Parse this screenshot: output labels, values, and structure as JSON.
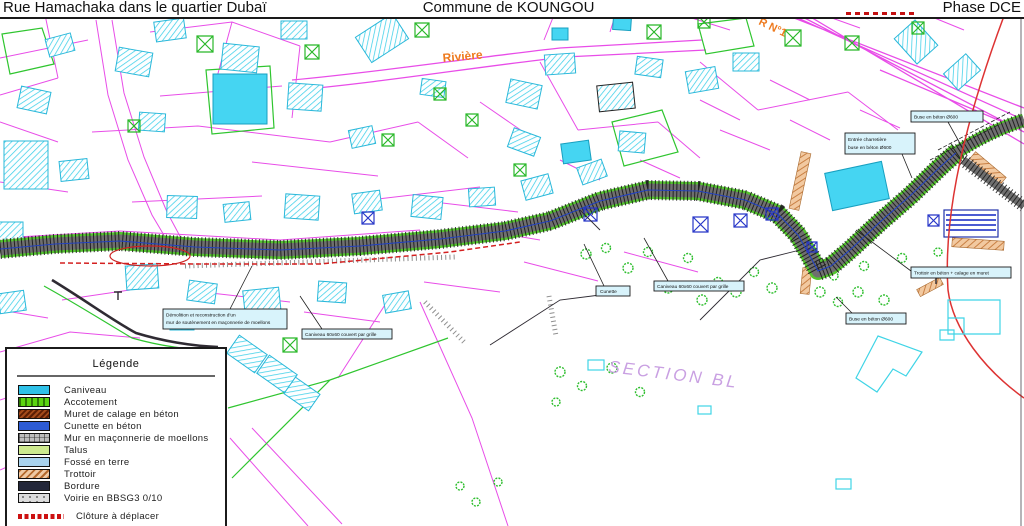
{
  "header": {
    "left_title": "Rue Hamachaka dans le quartier Dubaï",
    "center_title": "Commune de KOUNGOU",
    "right_title": "Phase DCE"
  },
  "map_labels": {
    "river": "Rivière",
    "rn1": "R N°1",
    "section": "SECTION BL"
  },
  "annotations": [
    {
      "line1": "Démolition et reconstruction d'un",
      "line2": "mur de soutènement en maçonnerie de moellons"
    },
    {
      "line1": "Caniveau 60x60 couvert par grille"
    },
    {
      "line1": "Cunette"
    },
    {
      "line1": "Caniveau 60x60 couvert par grille"
    },
    {
      "line1": "Entrée charretière",
      "line2": "buse en béton Ø600"
    },
    {
      "line1": "Buse en béton Ø600"
    },
    {
      "line1": "Trottoir en béton + calage en muret"
    },
    {
      "line1": "Buse en béton Ø600"
    }
  ],
  "legend": {
    "title": "Légende",
    "items": [
      {
        "label": "Caniveau",
        "color": "#2FC1E8"
      },
      {
        "label": "Accotement",
        "color": "#5BD411"
      },
      {
        "label": "Muret de calage en béton",
        "color": "#8A2F10"
      },
      {
        "label": "Cunette en béton",
        "color": "#2D5BD4"
      },
      {
        "label": "Mur en maçonnerie de moellons",
        "color": "#B3B3B3"
      },
      {
        "label": "Talus",
        "color": "#CDE98E"
      },
      {
        "label": "Fossé en terre",
        "color": "#A9D3EE"
      },
      {
        "label": "Trottoir",
        "color": "#E2AB77"
      },
      {
        "label": "Bordure",
        "color": "#23273A"
      },
      {
        "label": "Voirie en BBSG3 0/10",
        "color": "#D8D8D8"
      }
    ],
    "fence_item": {
      "label": "Clôture à déplacer",
      "color": "#CC1111"
    }
  },
  "colors": {
    "parcel_magenta": "#E84DE8",
    "building_cyan": "#2FC9E8",
    "vegetation_green": "#2DBE2D",
    "road_gray": "#6F6F6F",
    "axis_blue": "#2341C0",
    "fence_red": "#D42020",
    "label_orange": "#EE7A1E",
    "section_purple": "#C9A0E2"
  }
}
